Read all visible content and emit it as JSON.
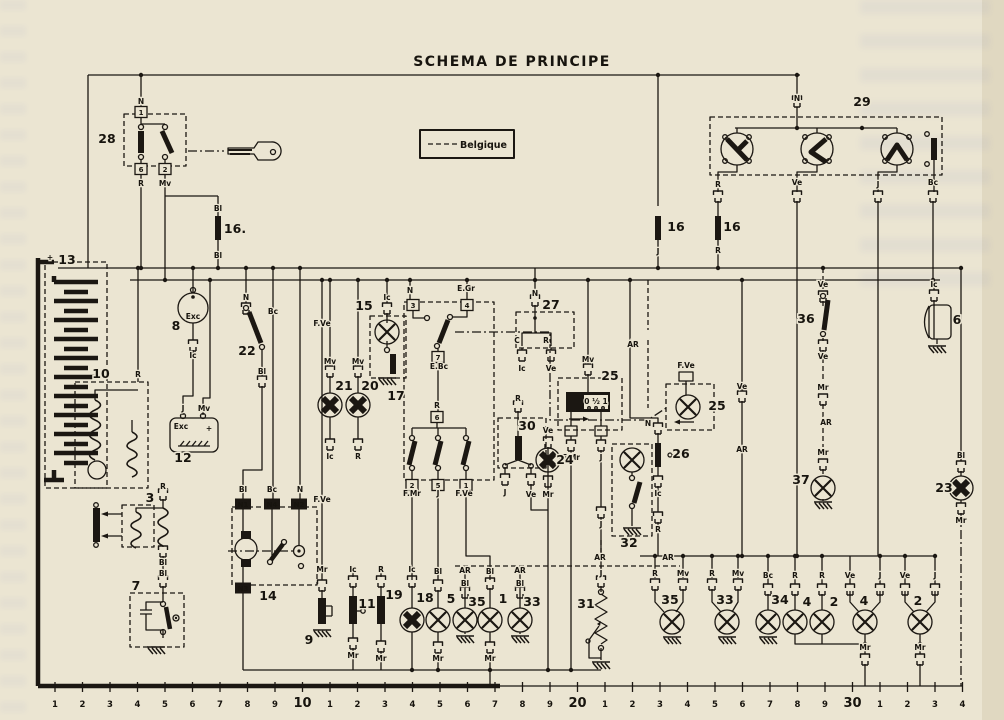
{
  "title": "SCHEMA DE PRINCIPE",
  "legend": {
    "label": "Belgique"
  },
  "colors": {
    "paper": "#ebe5d2",
    "ink": "#1b1712"
  },
  "component_numbers": [
    {
      "t": "28",
      "x": 107,
      "y": 143
    },
    {
      "t": "29",
      "x": 862,
      "y": 106
    },
    {
      "t": "16.",
      "x": 235,
      "y": 233
    },
    {
      "t": "16",
      "x": 676,
      "y": 231
    },
    {
      "t": "16",
      "x": 732,
      "y": 231
    },
    {
      "t": "13",
      "x": 67,
      "y": 264
    },
    {
      "t": "8",
      "x": 176,
      "y": 330
    },
    {
      "t": "10",
      "x": 101,
      "y": 378
    },
    {
      "t": "12",
      "x": 183,
      "y": 462
    },
    {
      "t": "22",
      "x": 247,
      "y": 355
    },
    {
      "t": "15",
      "x": 364,
      "y": 310
    },
    {
      "t": "21",
      "x": 344,
      "y": 390
    },
    {
      "t": "20",
      "x": 370,
      "y": 390
    },
    {
      "t": "17",
      "x": 396,
      "y": 400
    },
    {
      "t": "30",
      "x": 527,
      "y": 430
    },
    {
      "t": "27",
      "x": 551,
      "y": 309
    },
    {
      "t": "25",
      "x": 610,
      "y": 380
    },
    {
      "t": "24",
      "x": 565,
      "y": 464
    },
    {
      "t": "26",
      "x": 681,
      "y": 458
    },
    {
      "t": "25",
      "x": 717,
      "y": 410
    },
    {
      "t": "32",
      "x": 629,
      "y": 547
    },
    {
      "t": "36",
      "x": 806,
      "y": 323
    },
    {
      "t": "37",
      "x": 801,
      "y": 484
    },
    {
      "t": "6",
      "x": 957,
      "y": 324
    },
    {
      "t": "23",
      "x": 944,
      "y": 492
    },
    {
      "t": "3",
      "x": 150,
      "y": 502
    },
    {
      "t": "7",
      "x": 136,
      "y": 590
    },
    {
      "t": "14",
      "x": 268,
      "y": 600
    },
    {
      "t": "9",
      "x": 309,
      "y": 644
    },
    {
      "t": "11",
      "x": 367,
      "y": 608
    },
    {
      "t": "19",
      "x": 394,
      "y": 599
    },
    {
      "t": "18",
      "x": 425,
      "y": 602
    },
    {
      "t": "5",
      "x": 451,
      "y": 603
    },
    {
      "t": "35",
      "x": 477,
      "y": 606
    },
    {
      "t": "1",
      "x": 503,
      "y": 603
    },
    {
      "t": "33",
      "x": 532,
      "y": 606
    },
    {
      "t": "31",
      "x": 586,
      "y": 608
    },
    {
      "t": "35",
      "x": 670,
      "y": 604
    },
    {
      "t": "33",
      "x": 725,
      "y": 604
    },
    {
      "t": "34",
      "x": 780,
      "y": 604
    },
    {
      "t": "4",
      "x": 807,
      "y": 606
    },
    {
      "t": "2",
      "x": 834,
      "y": 606
    },
    {
      "t": "4",
      "x": 864,
      "y": 605
    },
    {
      "t": "2",
      "x": 918,
      "y": 605
    }
  ],
  "wire_labels": [
    {
      "t": "N",
      "x": 141,
      "y": 104
    },
    {
      "t": "R",
      "x": 141,
      "y": 186
    },
    {
      "t": "Mv",
      "x": 165,
      "y": 186
    },
    {
      "t": "Bl",
      "x": 218,
      "y": 211
    },
    {
      "t": "Bl",
      "x": 218,
      "y": 258
    },
    {
      "t": "N",
      "x": 797,
      "y": 101
    },
    {
      "t": "R",
      "x": 718,
      "y": 187
    },
    {
      "t": "Ve",
      "x": 797,
      "y": 185
    },
    {
      "t": "J",
      "x": 878,
      "y": 187
    },
    {
      "t": "Bc",
      "x": 933,
      "y": 185
    },
    {
      "t": "J",
      "x": 658,
      "y": 254
    },
    {
      "t": "R",
      "x": 718,
      "y": 253
    },
    {
      "t": "+",
      "x": 50,
      "y": 260,
      "s": 11
    },
    {
      "t": "R",
      "x": 138,
      "y": 377
    },
    {
      "t": "Exc",
      "x": 193,
      "y": 319,
      "s": 6.5
    },
    {
      "t": "Ic",
      "x": 193,
      "y": 358
    },
    {
      "t": "J",
      "x": 183,
      "y": 411
    },
    {
      "t": "Mv",
      "x": 204,
      "y": 411
    },
    {
      "t": "Exc",
      "x": 181,
      "y": 429,
      "s": 6.5
    },
    {
      "t": "+",
      "x": 209,
      "y": 431
    },
    {
      "t": "N",
      "x": 246,
      "y": 300
    },
    {
      "t": "Bc",
      "x": 273,
      "y": 314
    },
    {
      "t": "Bl",
      "x": 262,
      "y": 374
    },
    {
      "t": "Mv",
      "x": 330,
      "y": 364
    },
    {
      "t": "Mv",
      "x": 358,
      "y": 364
    },
    {
      "t": "Ic",
      "x": 330,
      "y": 459
    },
    {
      "t": "R",
      "x": 358,
      "y": 459
    },
    {
      "t": "Ic",
      "x": 387,
      "y": 300
    },
    {
      "t": "N",
      "x": 410,
      "y": 293
    },
    {
      "t": "E.Gr",
      "x": 466,
      "y": 291
    },
    {
      "t": "E.Bc",
      "x": 439,
      "y": 369
    },
    {
      "t": "R",
      "x": 437,
      "y": 408
    },
    {
      "t": "F.Mr",
      "x": 412,
      "y": 496
    },
    {
      "t": "J",
      "x": 438,
      "y": 496
    },
    {
      "t": "F.Ve",
      "x": 464,
      "y": 496
    },
    {
      "t": "R",
      "x": 518,
      "y": 401
    },
    {
      "t": "J",
      "x": 505,
      "y": 495
    },
    {
      "t": "Ve",
      "x": 531,
      "y": 497
    },
    {
      "t": "N",
      "x": 535,
      "y": 296
    },
    {
      "t": "C",
      "x": 517,
      "y": 343
    },
    {
      "t": "R",
      "x": 546,
      "y": 343
    },
    {
      "t": "Ic",
      "x": 522,
      "y": 371
    },
    {
      "t": "Ve",
      "x": 551,
      "y": 371
    },
    {
      "t": "Mv",
      "x": 588,
      "y": 362
    },
    {
      "t": "F.Mr",
      "x": 571,
      "y": 460
    },
    {
      "t": "J",
      "x": 601,
      "y": 460
    },
    {
      "t": "Ve",
      "x": 548,
      "y": 433
    },
    {
      "t": "Mr",
      "x": 548,
      "y": 497
    },
    {
      "t": "N",
      "x": 648,
      "y": 426
    },
    {
      "t": "Ic",
      "x": 658,
      "y": 496
    },
    {
      "t": "R",
      "x": 658,
      "y": 532
    },
    {
      "t": "AR",
      "x": 633,
      "y": 347
    },
    {
      "t": "F.Ve",
      "x": 686,
      "y": 368
    },
    {
      "t": "J",
      "x": 601,
      "y": 527
    },
    {
      "t": "AR",
      "x": 600,
      "y": 560
    },
    {
      "t": "J",
      "x": 601,
      "y": 576
    },
    {
      "t": "AR",
      "x": 668,
      "y": 560
    },
    {
      "t": "Ve",
      "x": 742,
      "y": 389
    },
    {
      "t": "AR",
      "x": 742,
      "y": 452
    },
    {
      "t": "Ve",
      "x": 823,
      "y": 287
    },
    {
      "t": "Ve",
      "x": 823,
      "y": 359
    },
    {
      "t": "Mr",
      "x": 823,
      "y": 390
    },
    {
      "t": "AR",
      "x": 826,
      "y": 425
    },
    {
      "t": "Mr",
      "x": 823,
      "y": 455
    },
    {
      "t": "Ic",
      "x": 934,
      "y": 287
    },
    {
      "t": "Bl",
      "x": 961,
      "y": 458
    },
    {
      "t": "Mr",
      "x": 961,
      "y": 523
    },
    {
      "t": "R",
      "x": 163,
      "y": 489
    },
    {
      "t": "Bl",
      "x": 163,
      "y": 565
    },
    {
      "t": "Bl",
      "x": 163,
      "y": 576
    },
    {
      "t": "Bl",
      "x": 243,
      "y": 492
    },
    {
      "t": "Bc",
      "x": 272,
      "y": 492
    },
    {
      "t": "N",
      "x": 300,
      "y": 492
    },
    {
      "t": "F.Ve",
      "x": 322,
      "y": 326
    },
    {
      "t": "F.Ve",
      "x": 322,
      "y": 502
    },
    {
      "t": "Mr",
      "x": 322,
      "y": 572
    },
    {
      "t": "Ic",
      "x": 353,
      "y": 572
    },
    {
      "t": "Mr",
      "x": 353,
      "y": 658
    },
    {
      "t": "R",
      "x": 381,
      "y": 572
    },
    {
      "t": "Mr",
      "x": 381,
      "y": 661
    },
    {
      "t": "Ic",
      "x": 412,
      "y": 572
    },
    {
      "t": "Bl",
      "x": 438,
      "y": 574
    },
    {
      "t": "Mr",
      "x": 438,
      "y": 661
    },
    {
      "t": "AR",
      "x": 465,
      "y": 573
    },
    {
      "t": "Bl",
      "x": 465,
      "y": 586
    },
    {
      "t": "Bl",
      "x": 490,
      "y": 574
    },
    {
      "t": "Mr",
      "x": 490,
      "y": 661
    },
    {
      "t": "AR",
      "x": 520,
      "y": 573
    },
    {
      "t": "Bl",
      "x": 520,
      "y": 586
    },
    {
      "t": "R",
      "x": 655,
      "y": 576
    },
    {
      "t": "Mv",
      "x": 683,
      "y": 576
    },
    {
      "t": "R",
      "x": 712,
      "y": 576
    },
    {
      "t": "Mv",
      "x": 738,
      "y": 576
    },
    {
      "t": "Bc",
      "x": 768,
      "y": 578
    },
    {
      "t": "R",
      "x": 795,
      "y": 578
    },
    {
      "t": "R",
      "x": 822,
      "y": 578
    },
    {
      "t": "Ve",
      "x": 850,
      "y": 578
    },
    {
      "t": "J",
      "x": 880,
      "y": 578
    },
    {
      "t": "Mr",
      "x": 865,
      "y": 650
    },
    {
      "t": "Ve",
      "x": 905,
      "y": 578
    },
    {
      "t": "J",
      "x": 935,
      "y": 578
    },
    {
      "t": "Mr",
      "x": 920,
      "y": 650
    },
    {
      "t": "0 ½ 1",
      "x": 596,
      "y": 404,
      "s": 6
    }
  ],
  "terminal_boxes": [
    {
      "t": "1",
      "x": 141,
      "y": 112
    },
    {
      "t": "6",
      "x": 141,
      "y": 169
    },
    {
      "t": "2",
      "x": 165,
      "y": 169
    },
    {
      "t": "3",
      "x": 413,
      "y": 305
    },
    {
      "t": "4",
      "x": 467,
      "y": 305
    },
    {
      "t": "7",
      "x": 438,
      "y": 357
    },
    {
      "t": "6",
      "x": 437,
      "y": 417
    },
    {
      "t": "2",
      "x": 412,
      "y": 485
    },
    {
      "t": "5",
      "x": 438,
      "y": 485
    },
    {
      "t": "1",
      "x": 466,
      "y": 485
    },
    {
      "t": "N1",
      "x": 243,
      "y": 504,
      "inv": true
    },
    {
      "t": "N4",
      "x": 272,
      "y": 504,
      "inv": true
    },
    {
      "t": "N2",
      "x": 299,
      "y": 504,
      "inv": true
    },
    {
      "t": "N3",
      "x": 243,
      "y": 588,
      "inv": true
    }
  ],
  "bottom_scale": {
    "numbers": [
      "1",
      "2",
      "3",
      "4",
      "5",
      "6",
      "7",
      "8",
      "9",
      "10",
      "1",
      "2",
      "3",
      "4",
      "5",
      "6",
      "7",
      "8",
      "9",
      "20",
      "1",
      "2",
      "3",
      "4",
      "5",
      "6",
      "7",
      "8",
      "9",
      "30",
      "1",
      "2",
      "3",
      "4"
    ],
    "start_x": 55,
    "step": 27.5,
    "tick_y1": 682,
    "tick_y2": 692,
    "text_y": 707
  }
}
